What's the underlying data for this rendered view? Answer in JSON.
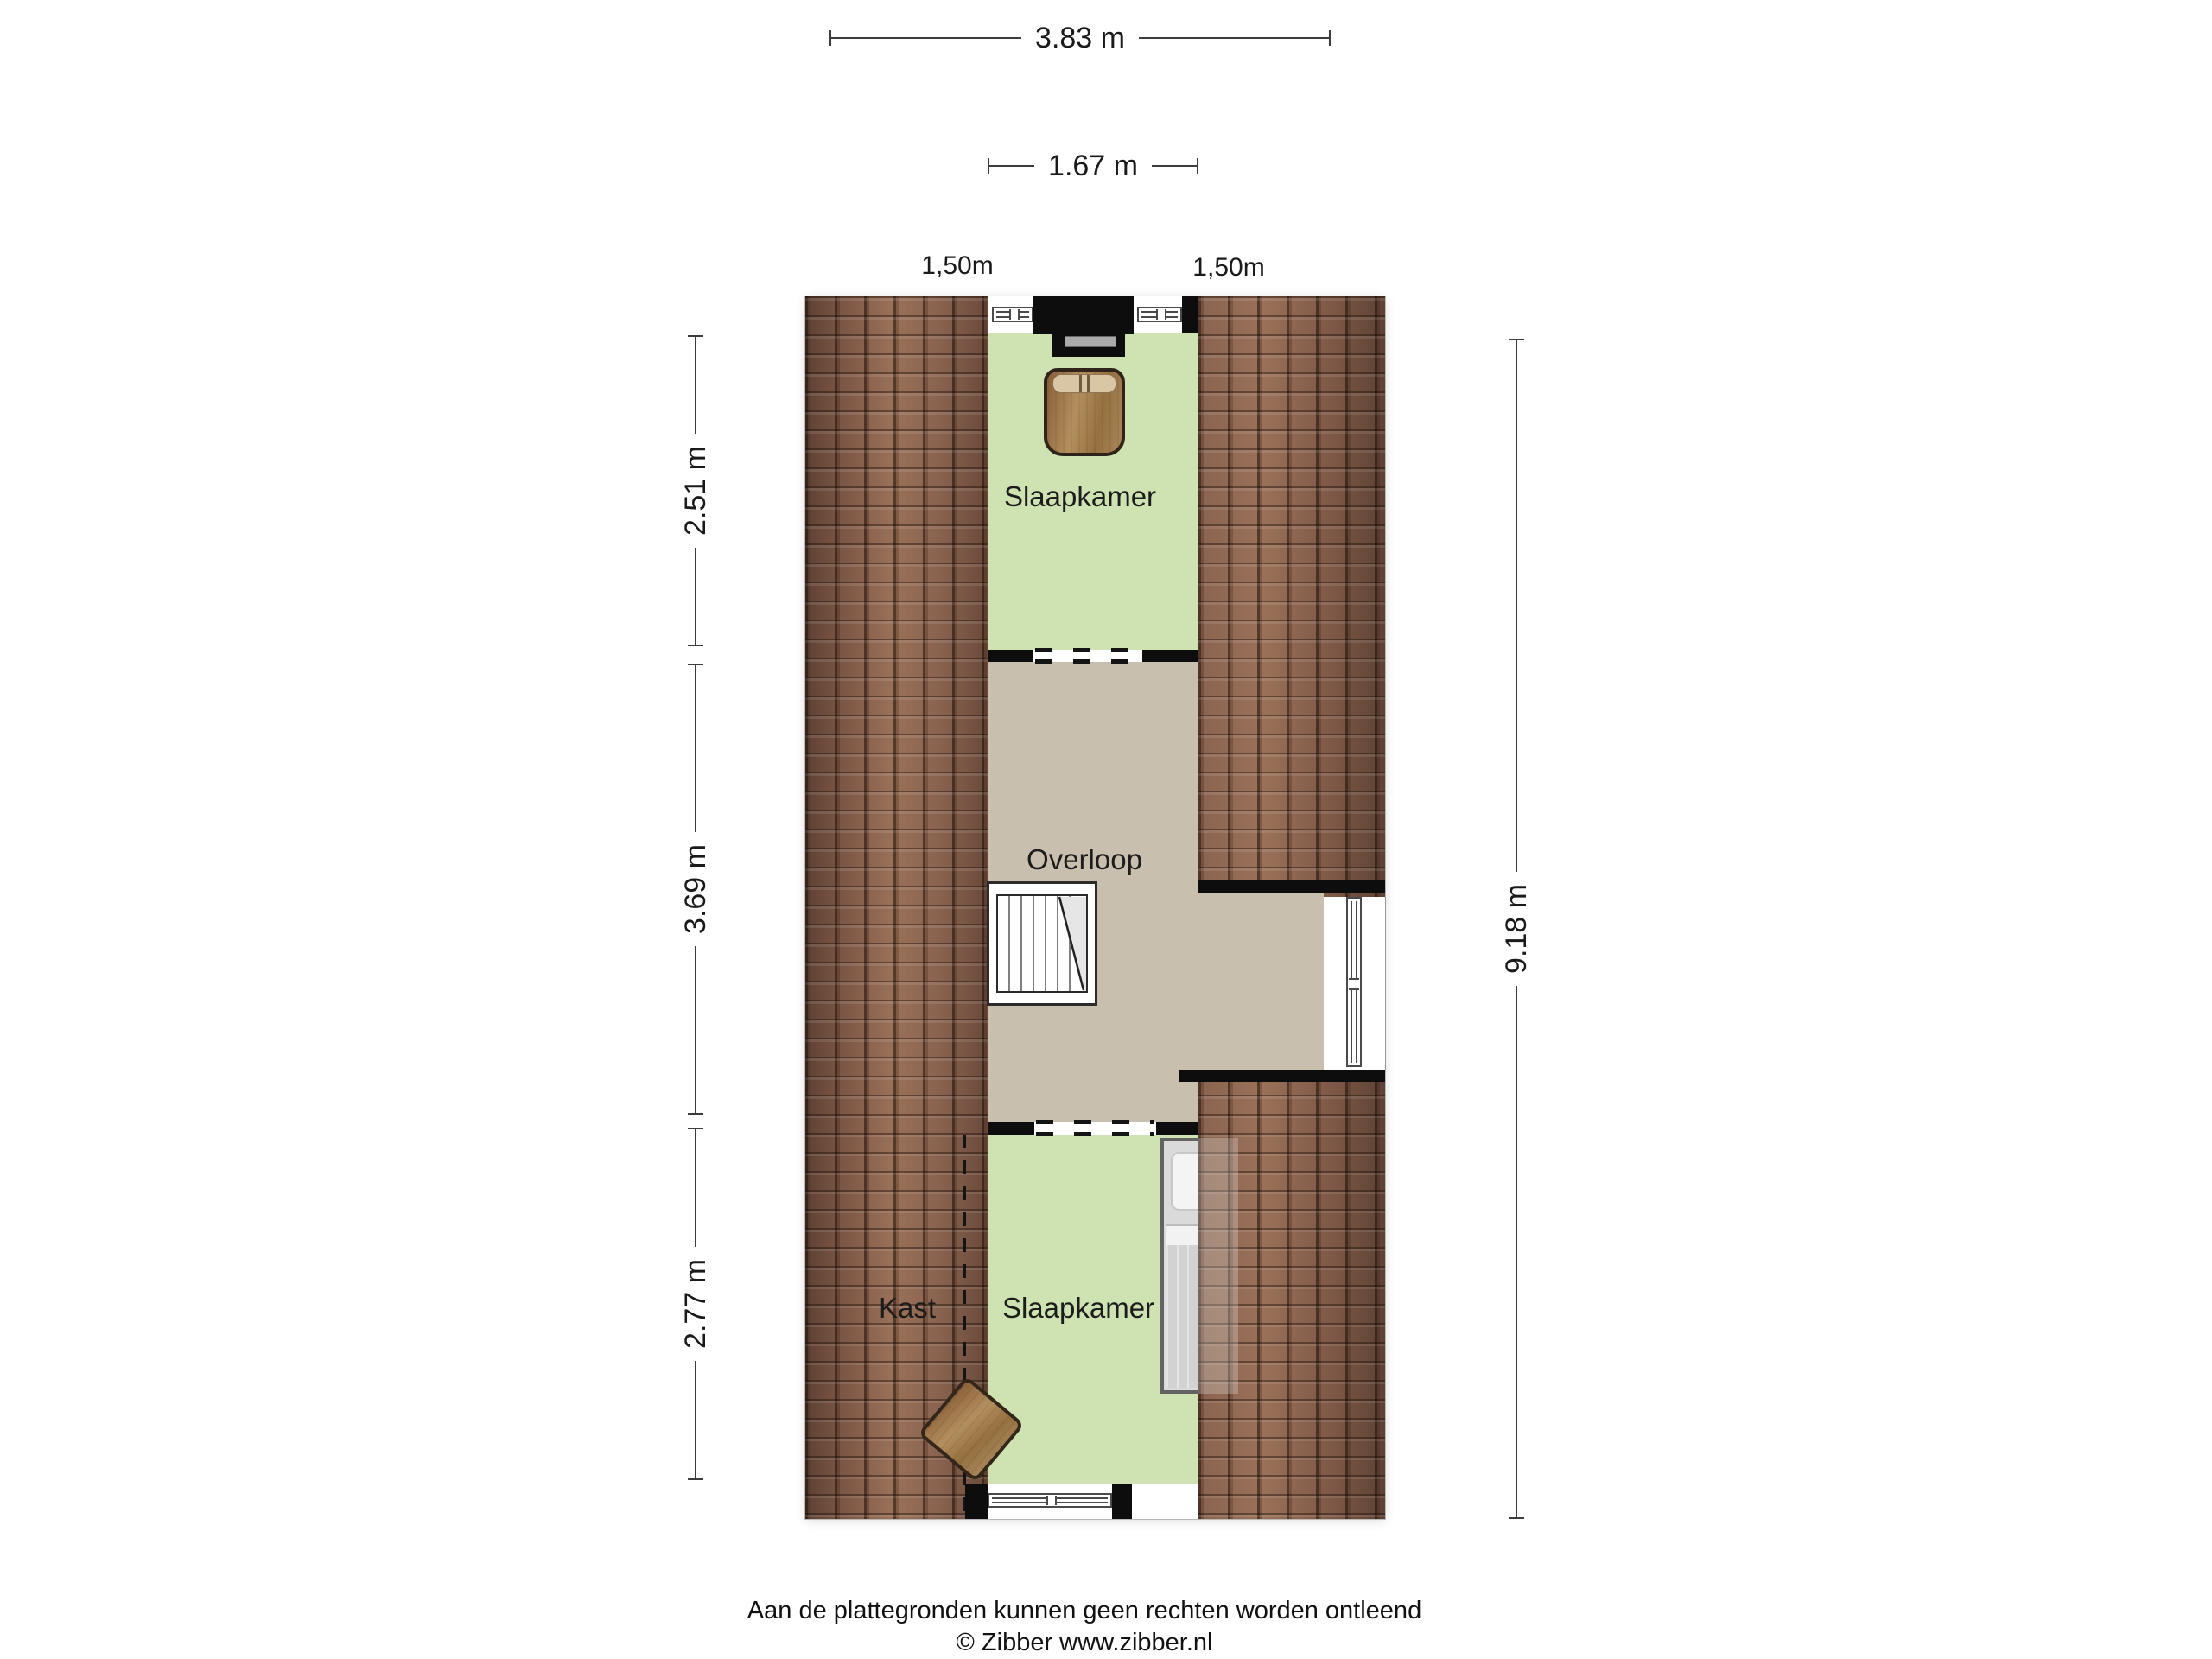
{
  "rooms": {
    "bedroom_top": "Slaapkamer",
    "landing": "Overloop",
    "bedroom_bottom": "Slaapkamer",
    "closet": "Kast"
  },
  "dimensions": {
    "total_width": "3.83 m",
    "inner_width": "1.67 m",
    "headroom_left": "1,50m",
    "headroom_right": "1,50m",
    "left_segments": [
      {
        "label": "2.51 m"
      },
      {
        "label": "3.69 m"
      },
      {
        "label": "2.77 m"
      }
    ],
    "total_height": "9.18 m"
  },
  "footer": {
    "disclaimer": "Aan de plattegronden kunnen geen rechten worden ontleend",
    "credit": "© Zibber www.zibber.nl"
  },
  "colors": {
    "room_green": "#cfe2b2",
    "landing": "#c9bfae",
    "roof": "#8a6450",
    "wall": "#0d0d0d"
  }
}
